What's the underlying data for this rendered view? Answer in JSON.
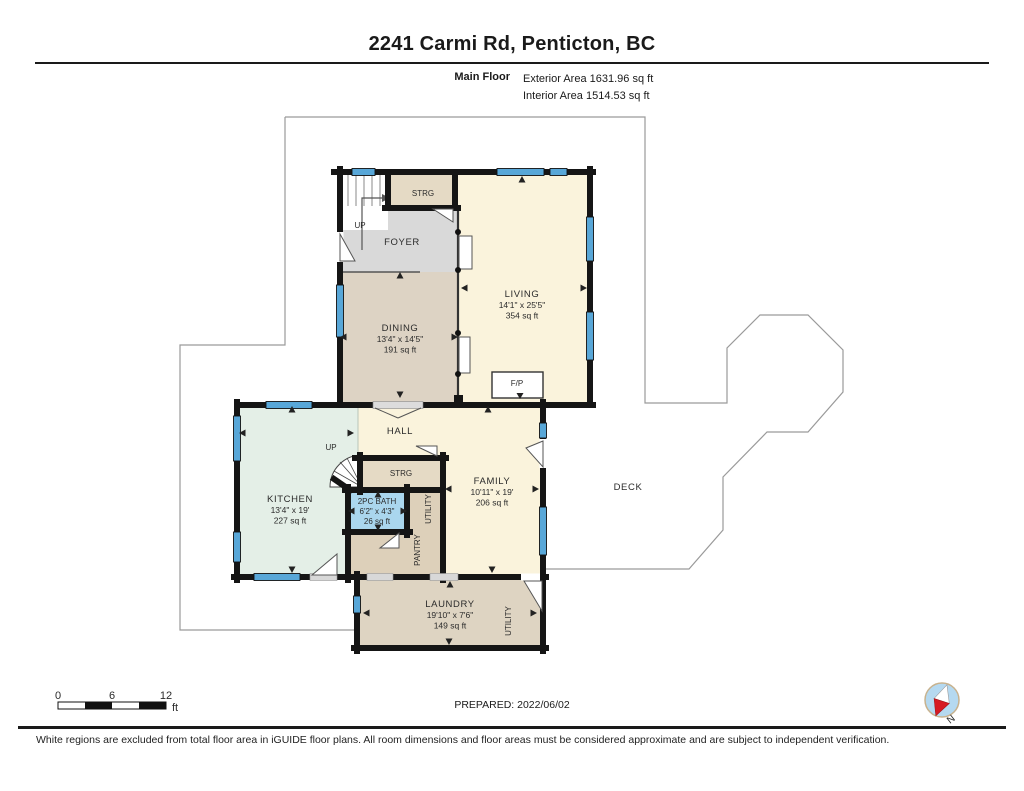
{
  "header": {
    "title": "2241 Carmi Rd, Penticton, BC",
    "floor_label": "Main Floor",
    "exterior_area": "Exterior Area 1631.96 sq ft",
    "interior_area": "Interior Area 1514.53 sq ft"
  },
  "plan": {
    "rooms": {
      "living": {
        "name": "LIVING",
        "dims": "14'1\" x 25'5\"",
        "area": "354 sq ft"
      },
      "dining": {
        "name": "DINING",
        "dims": "13'4\" x 14'5\"",
        "area": "191 sq ft"
      },
      "kitchen": {
        "name": "KITCHEN",
        "dims": "13'4\" x 19'",
        "area": "227 sq ft"
      },
      "family": {
        "name": "FAMILY",
        "dims": "10'11\" x 19'",
        "area": "206 sq ft"
      },
      "bath": {
        "name": "2PC BATH",
        "dims": "6'2\" x 4'3\"",
        "area": "26 sq ft"
      },
      "laundry": {
        "name": "LAUNDRY",
        "dims": "19'10\" x 7'6\"",
        "area": "149 sq ft"
      },
      "foyer": {
        "name": "FOYER"
      },
      "hall": {
        "name": "HALL"
      },
      "strg_top": {
        "name": "STRG"
      },
      "strg_mid": {
        "name": "STRG"
      },
      "utility_mid": {
        "name": "UTILITY"
      },
      "pantry": {
        "name": "PANTRY"
      },
      "utility_laundry": {
        "name": "UTILITY"
      },
      "deck": {
        "name": "DECK"
      },
      "fireplace": {
        "name": "F/P"
      },
      "stairs_up_top": {
        "name": "UP"
      },
      "stairs_up_mid": {
        "name": "UP"
      }
    }
  },
  "footer": {
    "scale_bar": {
      "tick_0": "0",
      "tick_6": "6",
      "tick_12": "12",
      "unit": "ft"
    },
    "prepared": "PREPARED: 2022/06/02",
    "compass": {
      "label": "N"
    },
    "disclaimer": "White regions are excluded from total floor area in iGUIDE floor plans. All room dimensions and floor areas must be considered approximate and are subject to independent verification."
  },
  "colors": {
    "wall": "#151515",
    "window_blue": "#58a7d8",
    "room_cream": "#faf3dc",
    "room_taupe": "#ddd3c4",
    "room_tan": "#e5dac5",
    "room_gray": "#d9d9d9",
    "room_mint": "#e4efe7",
    "room_bath_blue": "#aad6ee",
    "outline_gray": "#9a9a9a",
    "compass_fill": "#b5d9f0",
    "compass_needle_red": "#d61a22"
  }
}
